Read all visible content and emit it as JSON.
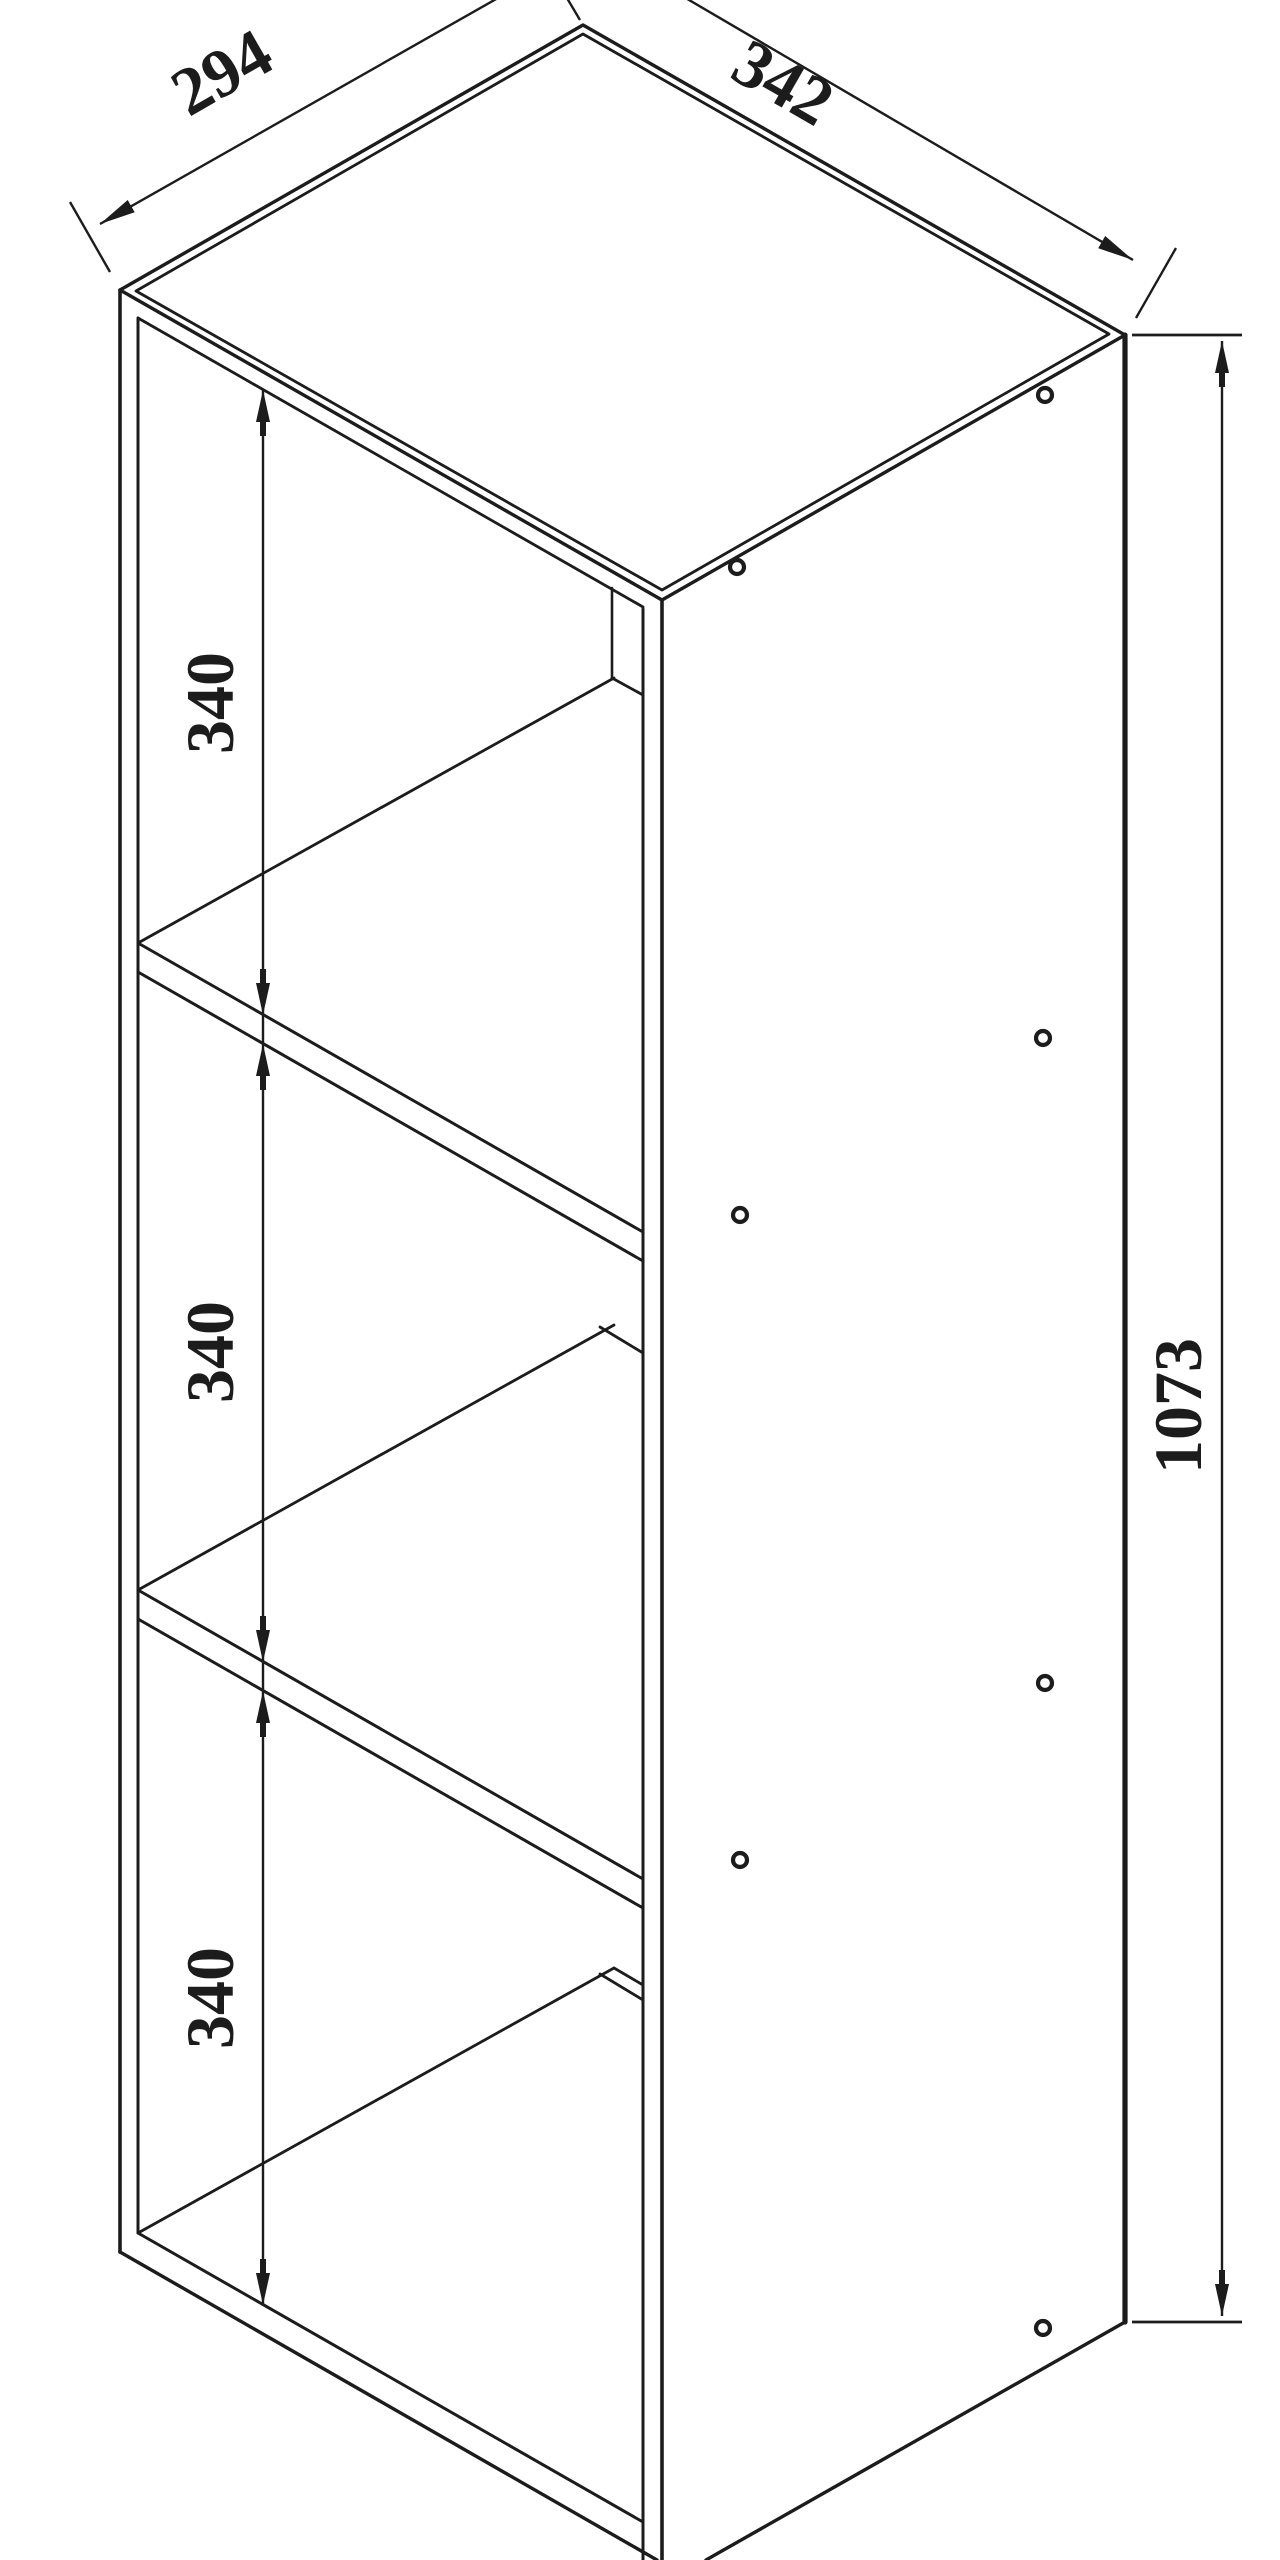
{
  "page": {
    "background": "#ffffff",
    "line_color": "#1c1c1c"
  },
  "drawing": {
    "kind": "isometric-technical-drawing",
    "subject": "3-cube open shelf cabinet",
    "dimension_labels": {
      "depth_top_left": "294",
      "width_top_right": "342",
      "overall_height_right": "1073",
      "cube_heights": [
        "340",
        "340",
        "340"
      ]
    },
    "screw_hole_count": 7
  }
}
